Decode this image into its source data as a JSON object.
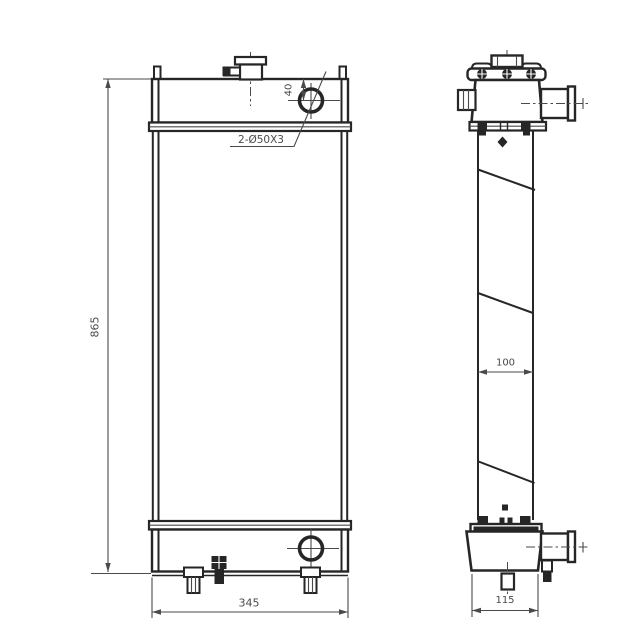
{
  "colors": {
    "line": "#262626",
    "dim": "#4a4a4a",
    "background": "#ffffff"
  },
  "front_view": {
    "dim_height": "865",
    "dim_width": "345",
    "dim_hole_offset": "40",
    "hole_callout": "2-Ø50X3"
  },
  "side_view": {
    "dim_core_width": "100",
    "dim_depth": "115"
  }
}
